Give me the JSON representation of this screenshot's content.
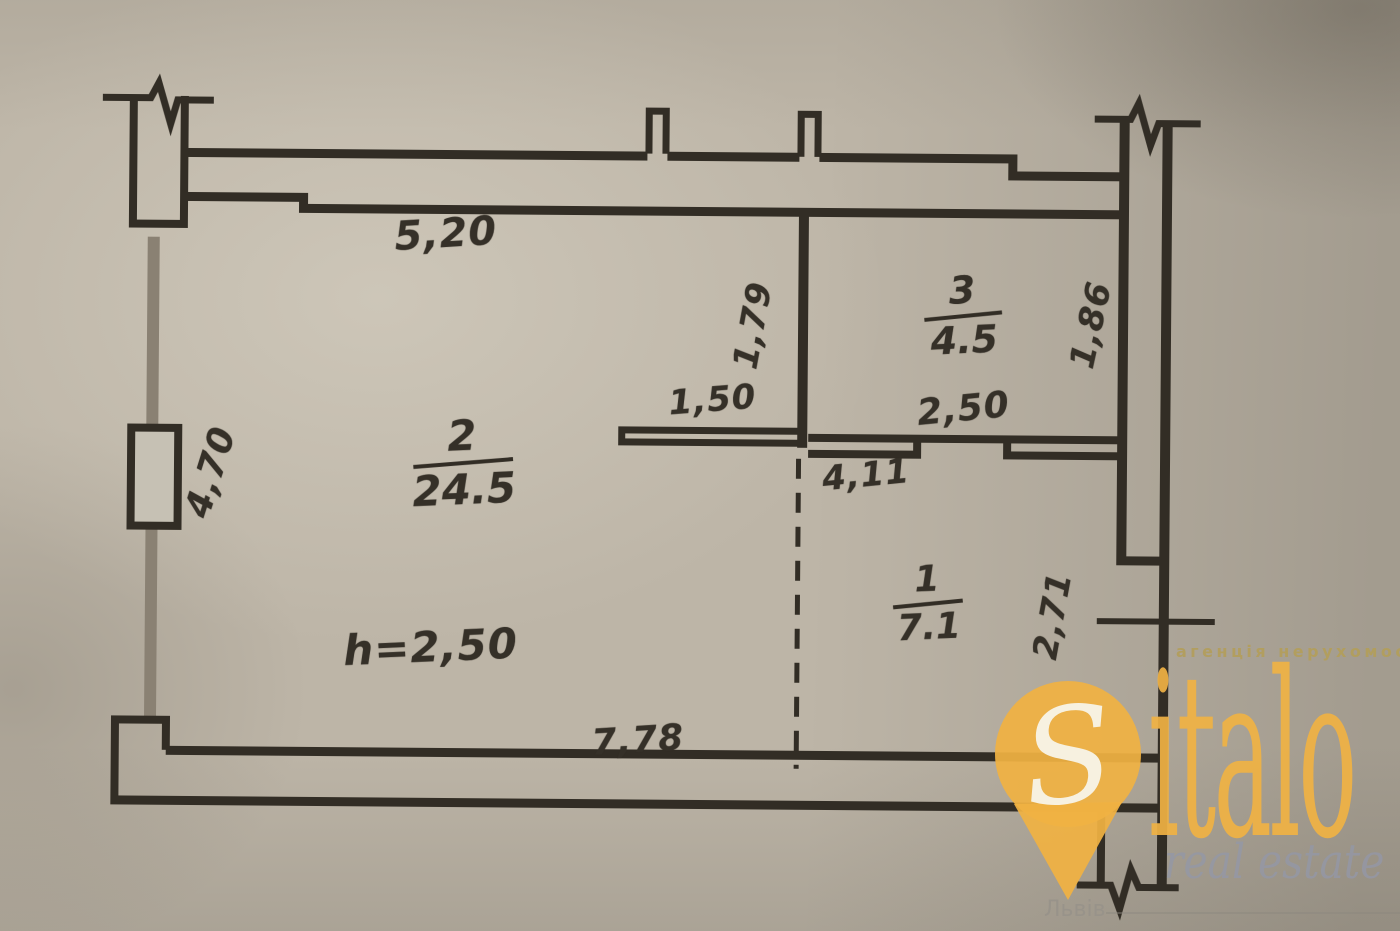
{
  "page": {
    "kind": "scanned floor plan photo with real-estate watermark"
  },
  "plan": {
    "rooms": [
      {
        "number": "2",
        "area": "24.5"
      },
      {
        "number": "3",
        "area": "4.5"
      },
      {
        "number": "1",
        "area": "7.1"
      }
    ],
    "height_note": "h=2,50",
    "dimensions": {
      "top_width": "5,20",
      "shelf_width": "1,50",
      "room3_width": "2,50",
      "corridor_width": "4,11",
      "partition_height": "1,79",
      "room3_depth": "1,86",
      "left_height": "4,70",
      "right_lower_height": "2,71",
      "bottom_width": "7,78"
    }
  },
  "watermark": {
    "brand_initial": "S",
    "brand_rest": "italo",
    "tagline": "агенція нерухомості",
    "subtitle": "real estate",
    "city": "Львів"
  },
  "colors": {
    "paper": "#bdb5a7",
    "ink": "#322d25",
    "gray_wall": "#8a8173",
    "accent_yellow": "#f0b243",
    "watermark_gray": "#9397a6"
  }
}
